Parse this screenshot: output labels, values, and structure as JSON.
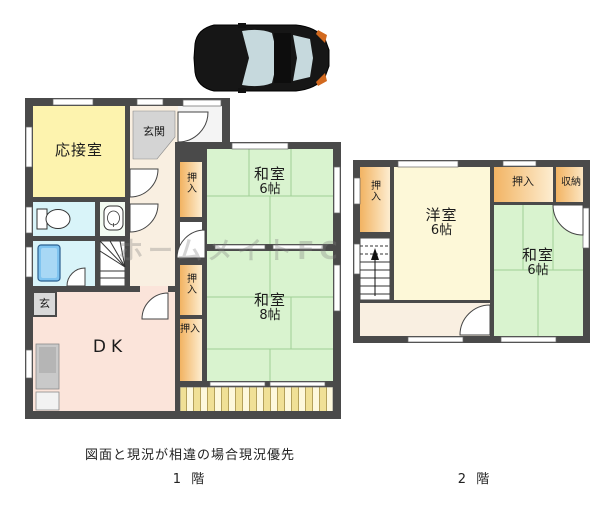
{
  "watermark": {
    "text": "ホームメイトFC"
  },
  "footer": {
    "disclaimer": "図面と現況が相違の場合現況優先"
  },
  "floor1": {
    "caption": "1 階",
    "rooms": {
      "reception": "応接室",
      "entrance": "玄関",
      "entrance_side": "玄",
      "closet": "押入",
      "tatami6": {
        "name": "和室",
        "size": "6帖"
      },
      "tatami8": {
        "name": "和室",
        "size": "8帖"
      },
      "dk": "DK"
    }
  },
  "floor2": {
    "caption": "2 階",
    "rooms": {
      "western6": {
        "name": "洋室",
        "size": "6帖"
      },
      "tatami6": {
        "name": "和室",
        "size": "6帖"
      },
      "closet": "押入",
      "storage": "収納"
    }
  },
  "icons": {
    "car": "car-top-view",
    "toilet": "toilet-icon",
    "sink": "sink-icon",
    "bathtub": "bathtub-icon",
    "stairs": "stairs-icon",
    "kitchen": "kitchen-counter"
  },
  "colors": {
    "wall": "#4a4a4a",
    "tatami_green": "#d9f3cf",
    "tatami_line": "#9fcf96",
    "western_room": "#fdf8d8",
    "reception_yellow": "#fdf3ae",
    "dk_pink": "#fbe4da",
    "hall_cream": "#f9efe1",
    "closet_orange_dark": "#f2b362",
    "closet_orange_light": "#fdedd0",
    "wet_area_cyan": "#d9f4f9",
    "bathtub_blue": "#7fc4f0",
    "entrance_gray": "#d4d4d4",
    "veranda_stripe": "#f0e096",
    "car_body": "#161616",
    "car_glass": "#c6d9dd",
    "car_light_orange": "#d2691e"
  }
}
